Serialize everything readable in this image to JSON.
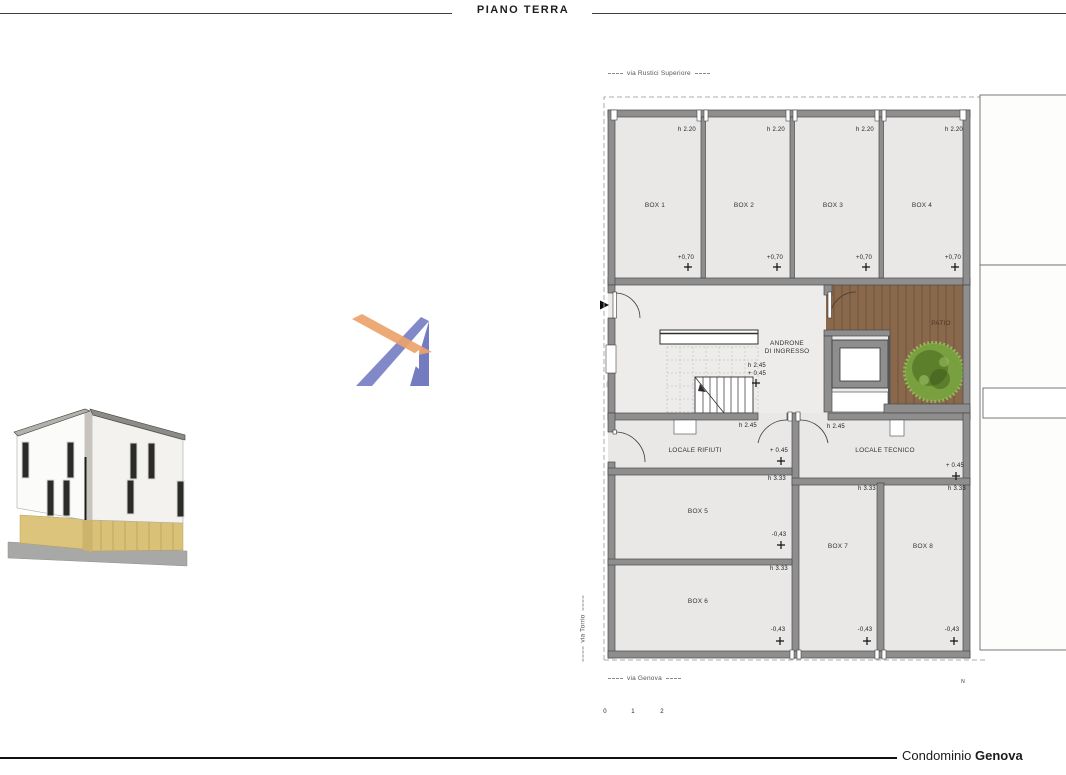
{
  "title": "PIANO TERRA",
  "footer": {
    "project_prefix": "Condominio ",
    "project_name": "Genova"
  },
  "streets": {
    "top": "via Rustici Superiore",
    "bottom": "via Genova",
    "left": "via Torrio"
  },
  "watermark": {
    "name_fragment": "NA",
    "tagline": "dal 2003"
  },
  "plan": {
    "rooms": {
      "box1": {
        "name": "BOX 1",
        "height": "h 2.20",
        "level": "+0,70"
      },
      "box2": {
        "name": "BOX 2",
        "height": "h 2.20",
        "level": "+0,70"
      },
      "box3": {
        "name": "BOX 3",
        "height": "h 2.20",
        "level": "+0,70"
      },
      "box4": {
        "name": "BOX 4",
        "height": "h 2.20",
        "level": "+0,70"
      },
      "androne": {
        "name_line1": "ANDRONE",
        "name_line2": "DI INGRESSO",
        "height": "h 2.45",
        "level": "+ 0.45"
      },
      "patio": {
        "name": "PATIO"
      },
      "rifiuti": {
        "name": "LOCALE RIFIUTI",
        "height": "h 2.45",
        "level": "+ 0.45"
      },
      "tecnico": {
        "name": "LOCALE TECNICO",
        "height": "h 2.45",
        "level": "+ 0.45"
      },
      "box5": {
        "name": "BOX 5",
        "height": "h 3.33",
        "level": "-0,43"
      },
      "box6": {
        "name": "BOX 6",
        "height": "h 3.33",
        "level": "-0,43"
      },
      "box7": {
        "name": "BOX 7",
        "height": "h 3.33",
        "level": "-0,43"
      },
      "box8": {
        "name": "BOX 8",
        "height": "h 3.33",
        "level": "-0,43"
      }
    },
    "scalebar": {
      "tick0": "0",
      "tick1": "1",
      "tick2": "2"
    },
    "compass": {
      "north": "N"
    }
  },
  "colors": {
    "wall": "#8e8e8e",
    "floor": "#e9e8e7",
    "wood": "#8a684c",
    "tree": "#79a03e",
    "logo_blue": "#7b84c4",
    "logo_orange": "#eba36b"
  }
}
